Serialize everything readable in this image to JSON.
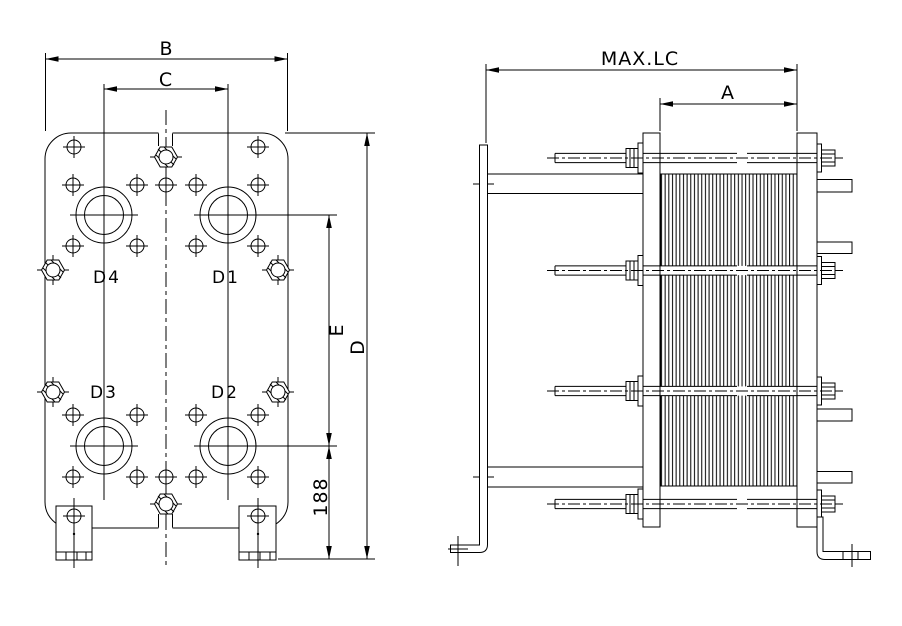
{
  "drawing": {
    "type": "plate-heat-exchanger-dimensional-drawing",
    "views": {
      "front": {
        "dims": {
          "b": "B",
          "c": "C",
          "e": "E",
          "d": "D",
          "n188": "188"
        },
        "ports": {
          "d1": "D1",
          "d2": "D2",
          "d3": "D3",
          "d4": "D4"
        }
      },
      "side": {
        "dims": {
          "max_lc": "MAX.LC",
          "a": "A"
        }
      }
    },
    "colors": {
      "line": "#000000",
      "background": "#ffffff"
    }
  }
}
